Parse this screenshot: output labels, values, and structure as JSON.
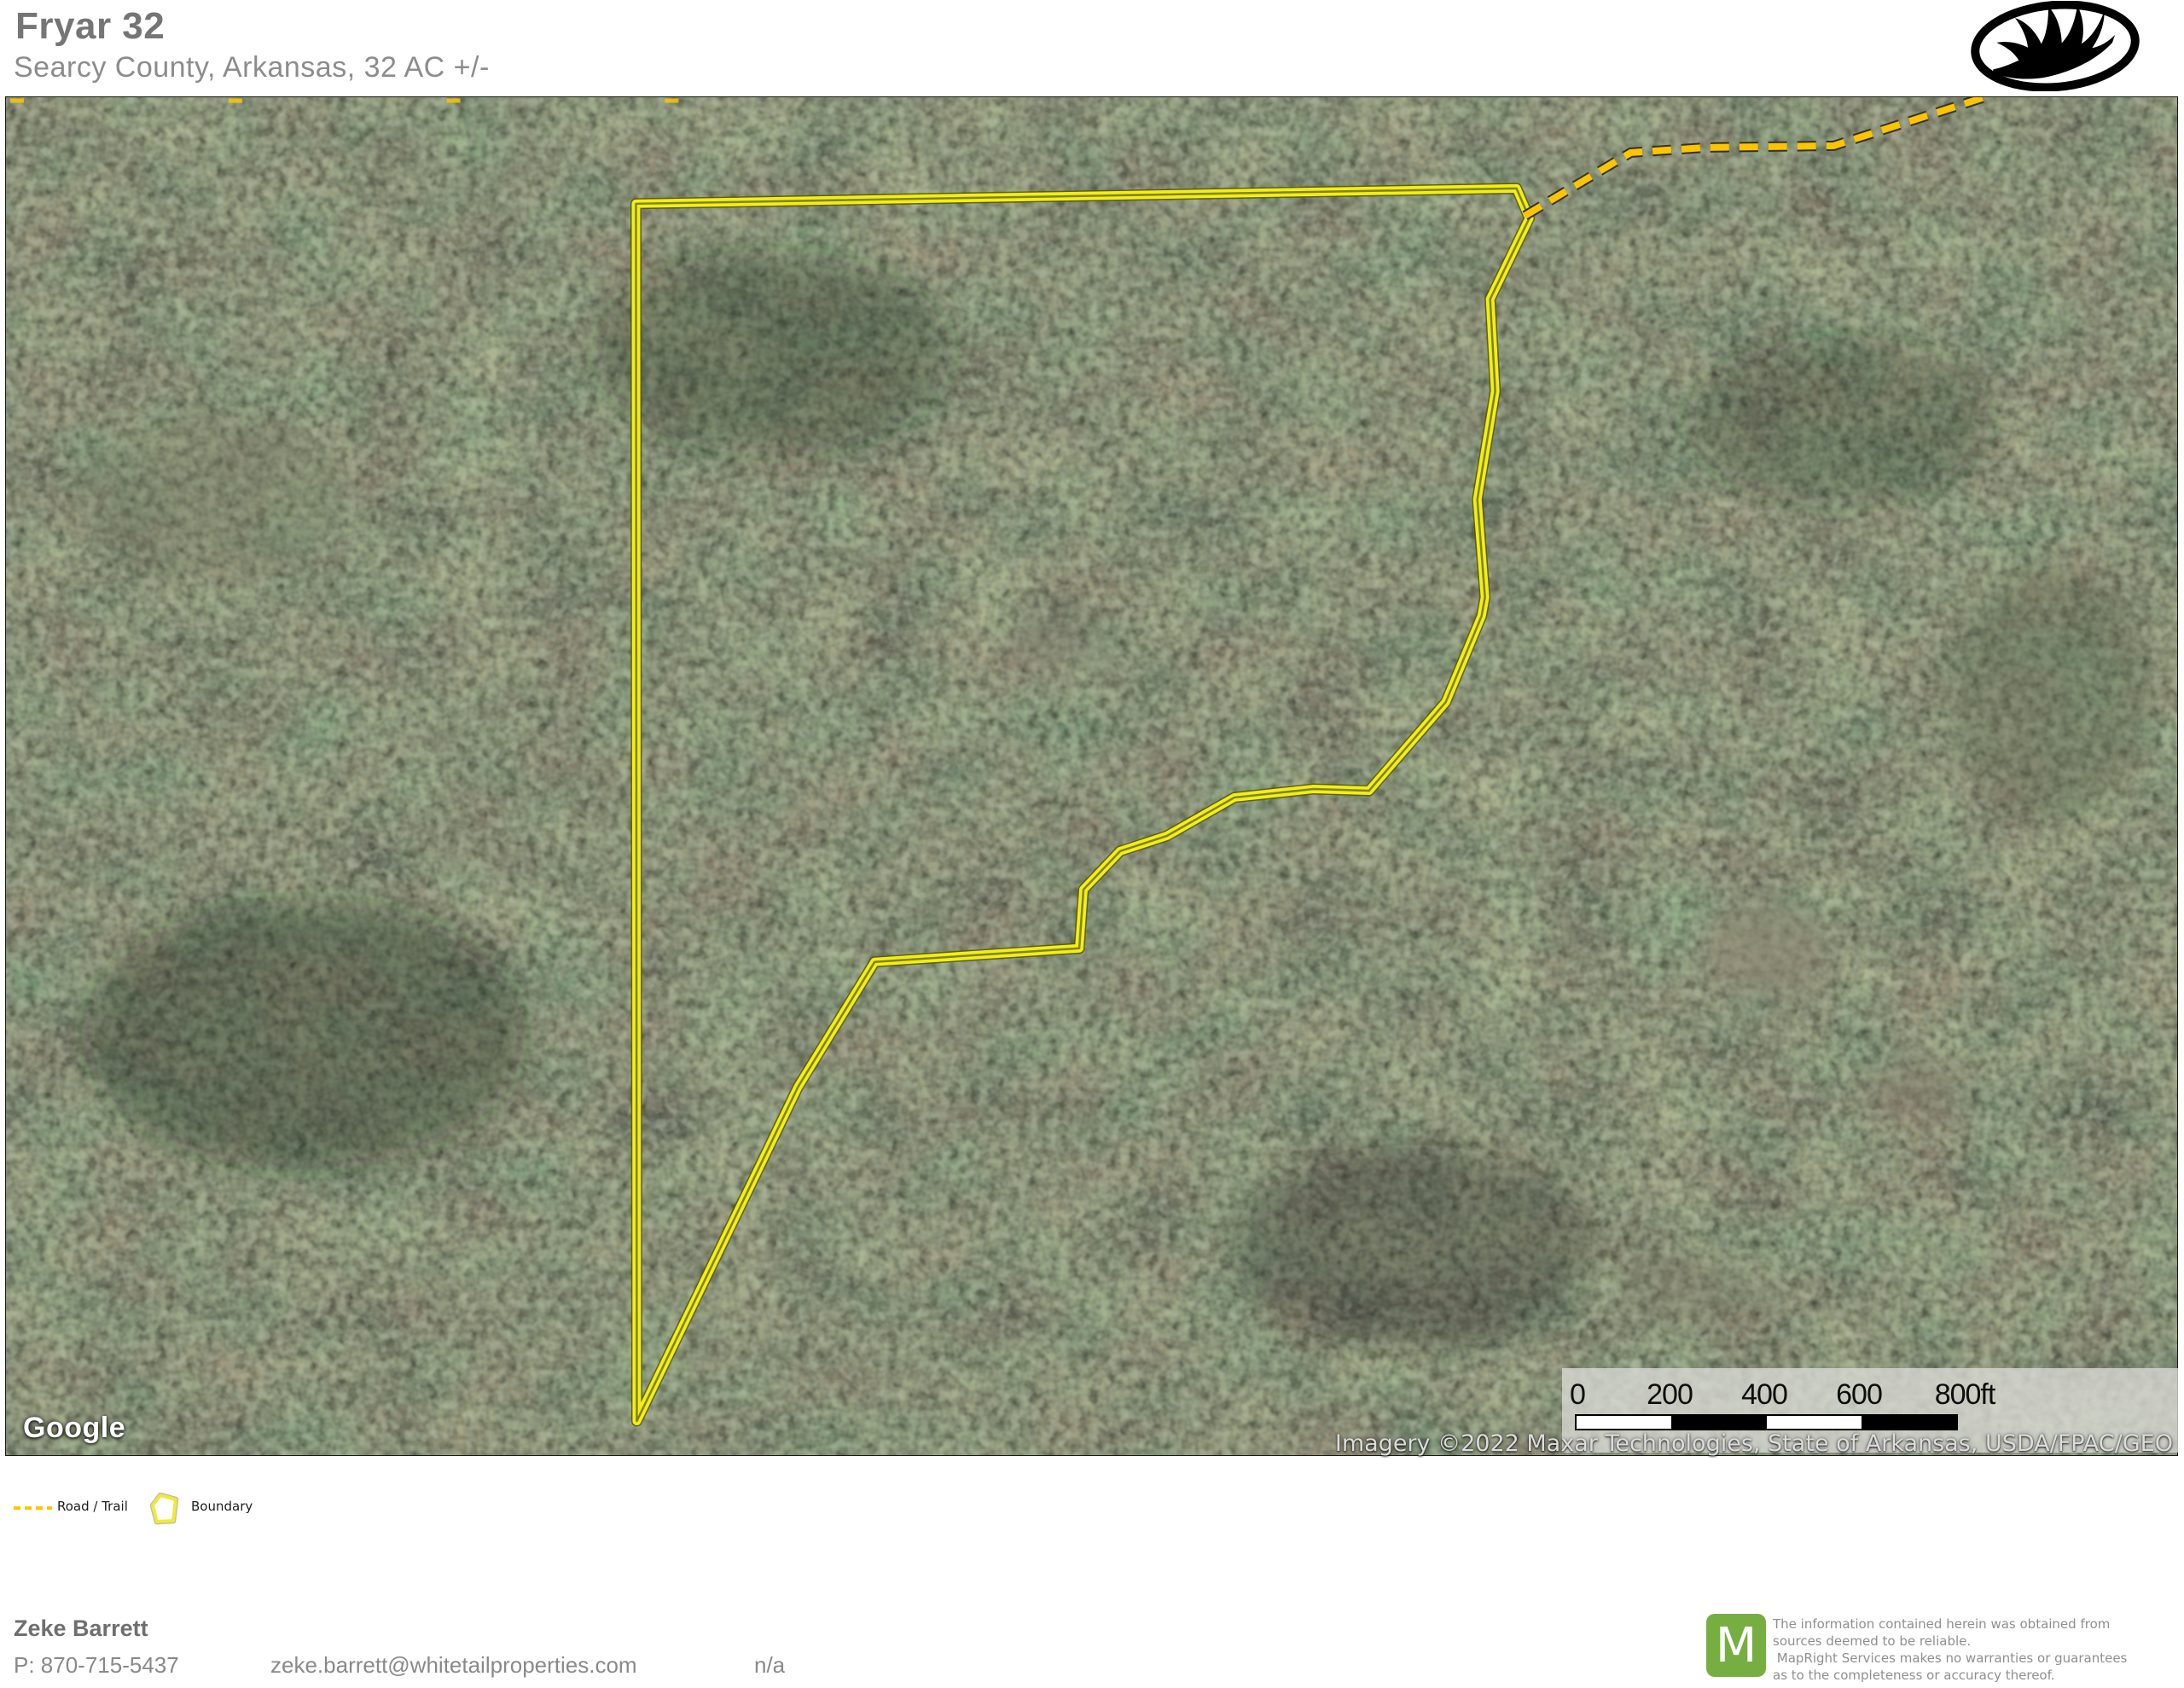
{
  "header": {
    "title": "Fryar 32",
    "subtitle": "Searcy County, Arkansas, 32 AC +/-",
    "brand_logo": "whitetail-properties-antler-logo"
  },
  "map": {
    "provider_logo_text": "Google",
    "attribution": "Imagery ©2022 Maxar Technologies, State of Arkansas, USDA/FPAC/GEO",
    "scale_bar": {
      "labels": [
        "0",
        "200",
        "400",
        "600",
        "800ft"
      ]
    },
    "boundary_color": "#f2ef16",
    "road_color": "#fdc500",
    "boundary_points": "739,125 1772,107 1787,142 1741,237 1747,345 1726,472 1735,587 1731,609 1689,710 1599,814 1534,812 1441,822 1362,867 1307,885 1264,930 1259,999 1019,1015 929,1162 740,1554",
    "road_points": "1782,139 1906,65 1994,59 2144,57 2321,0",
    "edge_road_points": "5,4 900,4"
  },
  "legend": {
    "road_label": "Road / Trail",
    "boundary_label": "Boundary"
  },
  "footer": {
    "agent_name": "Zeke Barrett",
    "phone": "P: 870-715-5437",
    "email": "zeke.barrett@whitetailproperties.com",
    "listing_extra": "n/a",
    "mapright_initial": "M",
    "disclaimer_lines": [
      "The information contained herein was obtained from",
      "sources deemed to be reliable.",
      " MapRight Services makes no warranties or guarantees",
      "as to the completeness or accuracy thereof."
    ]
  }
}
